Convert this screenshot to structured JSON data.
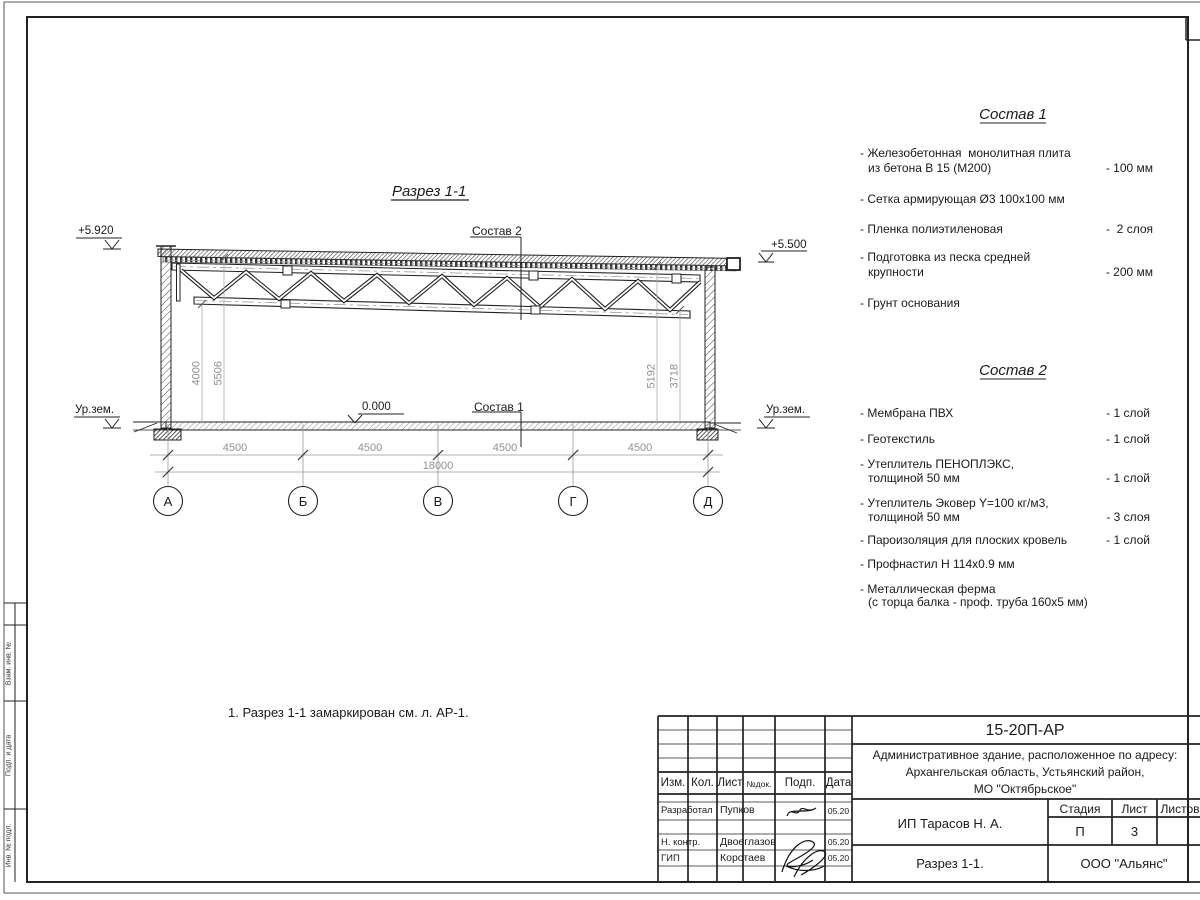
{
  "page": {
    "section_title": "Разрез 1-1",
    "note": "1. Разрез 1-1 замаркирован см. л. АР-1."
  },
  "drawing": {
    "elev_left": "+5.920",
    "elev_right": "+5.500",
    "ground_label": "Ур.зем.",
    "zero_level": "0.000",
    "leader_top": "Состав 2",
    "leader_floor": "Состав 1",
    "dim_v_left_1": "4000",
    "dim_v_left_2": "5506",
    "dim_v_right_1": "5192",
    "dim_v_right_2": "3718",
    "dims_span": [
      "4500",
      "4500",
      "4500",
      "4500"
    ],
    "dim_total": "18000",
    "axes": [
      "А",
      "Б",
      "В",
      "Г",
      "Д"
    ]
  },
  "sostav1": {
    "title": "Состав 1",
    "items": [
      {
        "l1": "- Железобетонная  монолитная плита",
        "l2": "из бетона В 15 (М200)",
        "v": "- 100 мм"
      },
      {
        "l1": "- Сетка армирующая Ø3 100х100 мм"
      },
      {
        "l1": "- Пленка полиэтиленовая",
        "v": "-  2 слоя"
      },
      {
        "l1": "- Подготовка из песка средней",
        "l2": "крупности",
        "v": "- 200 мм"
      },
      {
        "l1": "- Грунт основания"
      }
    ]
  },
  "sostav2": {
    "title": "Состав 2",
    "items": [
      {
        "l1": "- Мембрана ПВХ",
        "v": "- 1 слой"
      },
      {
        "l1": "- Геотекстиль",
        "v": "- 1 слой"
      },
      {
        "l1": "- Утеплитель ПЕНОПЛЭКС,",
        "l2": "толщиной 50 мм",
        "v": "- 1 слой"
      },
      {
        "l1": "- Утеплитель Эковер Y=100 кг/м3,",
        "l2": "толщиной 50 мм",
        "v": "- 3 слоя"
      },
      {
        "l1": "- Пароизоляция для плоских кровель",
        "v": "- 1 слой"
      },
      {
        "l1": "- Профнастил Н 114х0.9 мм"
      },
      {
        "l1": "- Металлическая ферма",
        "l2": "(с торца балка - проф. труба 160х5 мм)"
      }
    ]
  },
  "titleblock": {
    "doc_number": "15-20П-АР",
    "address1": "Административное здание, расположенное по адресу:",
    "address2": "Архангельская область, Устьянский район,",
    "address3": "МО \"Октябрьское\"",
    "col_izm": "Изм.",
    "col_kol": "Кол.",
    "col_list": "Лист",
    "col_ndok": "№док.",
    "col_podp": "Подп.",
    "col_data": "Дата",
    "rows": [
      {
        "role": "Разработал",
        "name": "Пупков",
        "date": "05.20"
      },
      {
        "role": "Н. контр.",
        "name": "Двоеглазов",
        "date": "05.20"
      },
      {
        "role": "ГИП",
        "name": "Коротаев",
        "date": "05.20"
      }
    ],
    "stage_label": "Стадия",
    "sheet_label": "Лист",
    "sheets_label": "Листов",
    "stage": "П",
    "sheet": "3",
    "client": "ИП Тарасов Н. А.",
    "sheet_name": "Разрез 1-1.",
    "company": "ООО \"Альянс\""
  },
  "sidestamp": {
    "vzam": "Взам. инв. №",
    "podp": "Подп. и дата",
    "inv": "Инв. № подл."
  }
}
